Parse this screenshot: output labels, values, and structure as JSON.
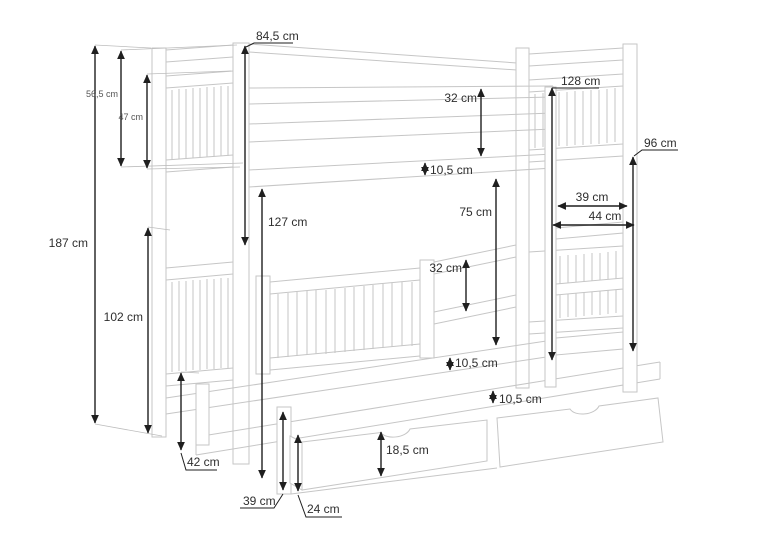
{
  "drawing": {
    "subject": "bunk-bed-with-trundle-and-drawers-technical-drawing",
    "unit_style": "cm",
    "colors": {
      "outline": "#c6c6c6",
      "dimension": "#1f1f1f",
      "label": "#2e2e2e",
      "background": "#ffffff"
    }
  },
  "labels": {
    "height_total": "187 cm",
    "headboard_top": "56,5 cm",
    "guardrail_upper_inner": "47 cm",
    "bed_width": "84,5 cm",
    "upper_rail_band": "32 cm",
    "upper_frame_thickness": "10,5 cm",
    "upper_bed_height": "128 cm",
    "ladder_height": "96 cm",
    "bunk_gap": "75 cm",
    "lower_bed_height": "127 cm",
    "ladder_width": "39 cm",
    "ladder_depth": "44 cm",
    "lower_rail_band": "32 cm",
    "lower_frame_thickness": "10,5 cm",
    "trundle_frame_thickness": "10,5 cm",
    "trundle_height": "42 cm",
    "lower_section_height": "102 cm",
    "front_post_height": "39 cm",
    "drawer_clearance": "24 cm",
    "drawer_front_height": "18,5 cm"
  }
}
